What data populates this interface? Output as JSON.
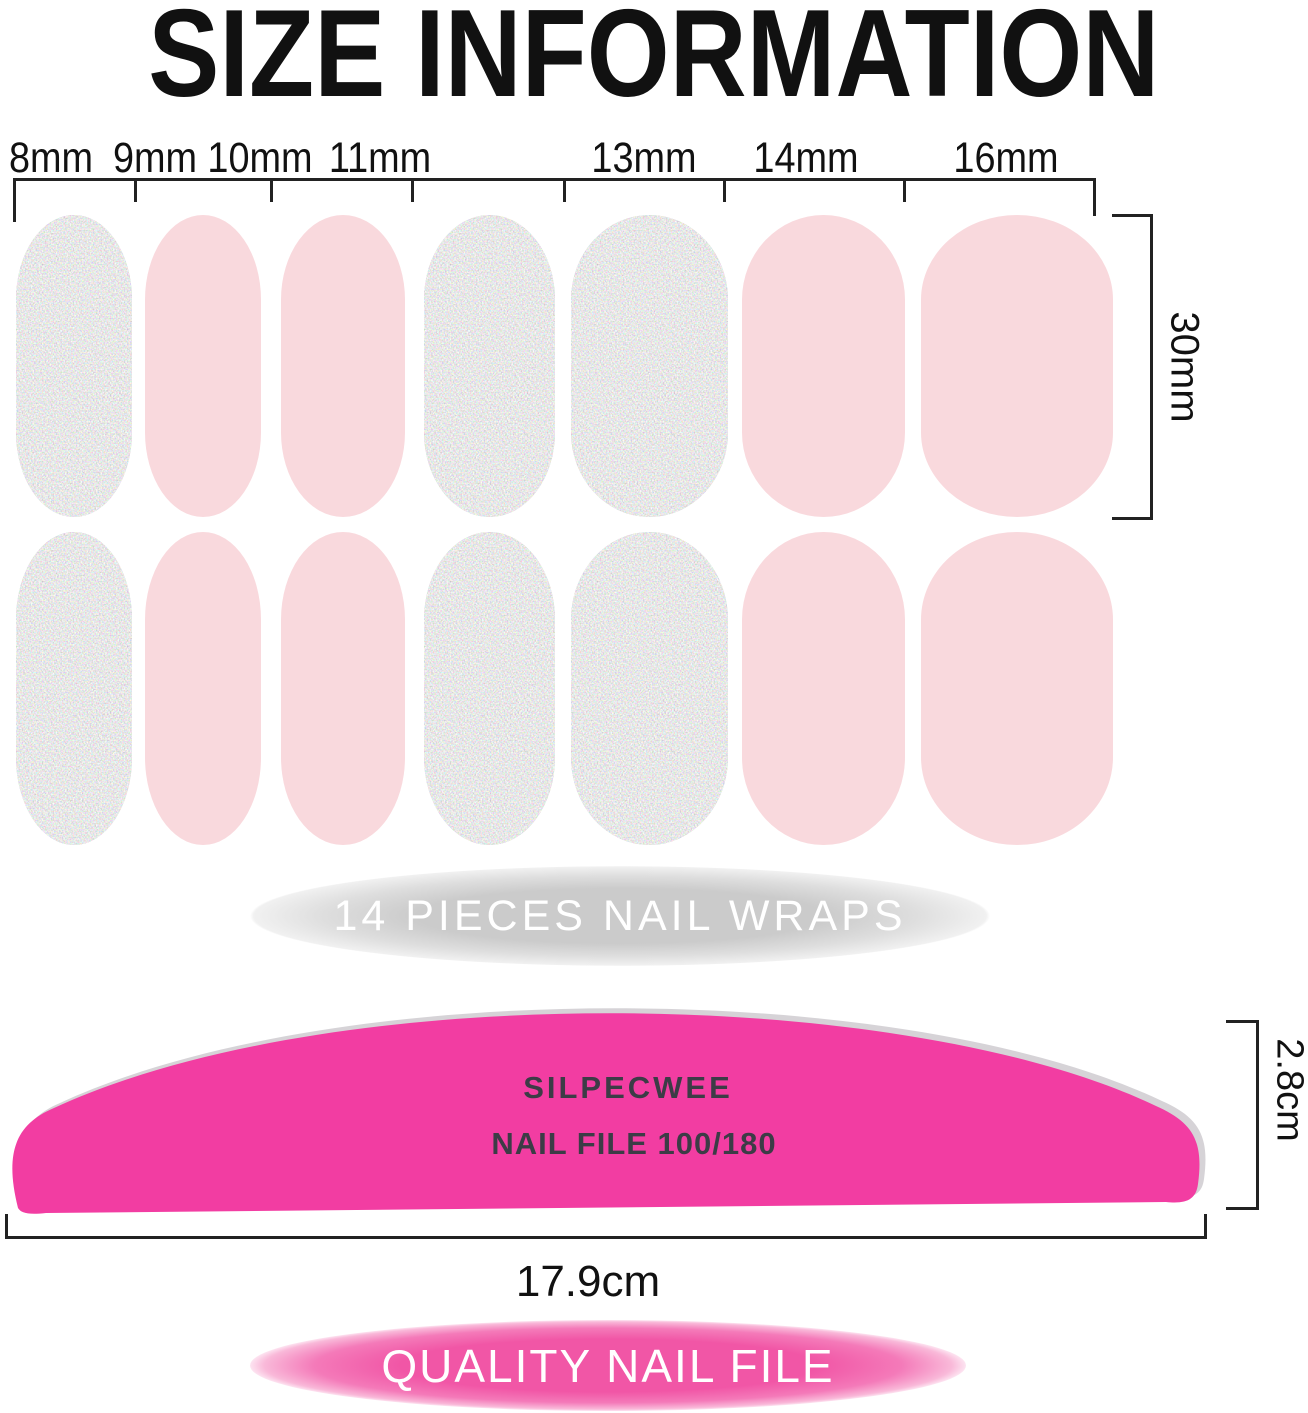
{
  "title": "SIZE INFORMATION",
  "colors": {
    "text_black": "#111111",
    "line": "#222222",
    "pink_nail": "#f9d9dd",
    "silver_base": "#c8c8c8",
    "file_pink": "#f23da2",
    "file_shadow": "#b5aeb6",
    "file_text": "#3c3c46",
    "badge_gray_center": "#cbcbcb",
    "badge_pink_center": "#f156a6",
    "badge_pink_edge": "#f9b9d9",
    "badge_text": "#ffffff"
  },
  "size_chart": {
    "column_labels": [
      "8mm",
      "9mm",
      "10mm",
      "11mm",
      "13mm",
      "14mm",
      "16mm"
    ],
    "height_label": "30mm",
    "rows": [
      [
        "silver",
        "pink",
        "pink",
        "silver",
        "silver",
        "pink",
        "pink"
      ],
      [
        "silver",
        "pink",
        "pink",
        "silver",
        "silver",
        "pink",
        "pink"
      ]
    ],
    "caption": "14 PIECES NAIL WRAPS"
  },
  "nail_file": {
    "brand": "SILPECWEE",
    "model": "NAIL FILE 100/180",
    "height_label": "2.8cm",
    "width_label": "17.9cm",
    "caption": "QUALITY NAIL FILE"
  }
}
